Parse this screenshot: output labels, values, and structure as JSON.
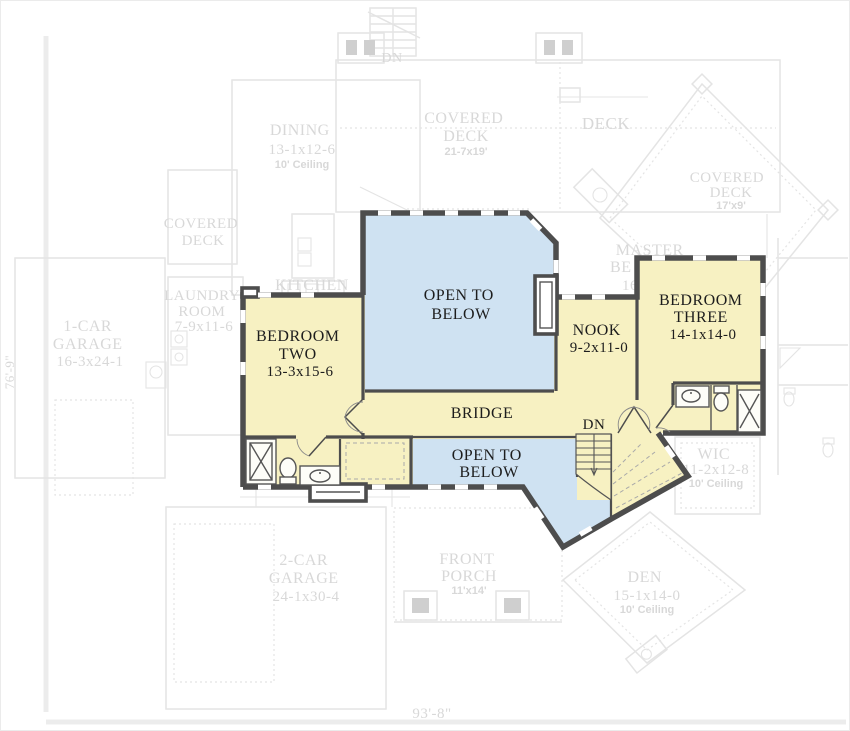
{
  "colors": {
    "room_fill": "#f7f1c2",
    "open_fill": "#cfe2f2",
    "wall": "#4d4d4d",
    "ghost": "#e4e4e4",
    "ghost_text": "#d8d8d8",
    "label_text": "#1d1d1d"
  },
  "dimensions": {
    "bottom_width": "93'-8\"",
    "left_height": "76'-9\""
  },
  "upper_floor": {
    "bedroom_two": {
      "l1": "BEDROOM",
      "l2": "TWO",
      "l3": "13-3x15-6"
    },
    "bedroom_three": {
      "l1": "BEDROOM",
      "l2": "THREE",
      "l3": "14-1x14-0"
    },
    "nook": {
      "l1": "NOOK",
      "l2": "9-2x11-0"
    },
    "open_to_below_main": {
      "l1": "OPEN TO",
      "l2": "BELOW"
    },
    "open_to_below_lower": {
      "l1": "OPEN TO",
      "l2": "BELOW"
    },
    "bridge": {
      "l1": "BRIDGE"
    },
    "stairs": {
      "l1": "DN"
    }
  },
  "ghost_floor": {
    "dn_top": {
      "l1": "DN"
    },
    "dining": {
      "l1": "DINING",
      "l2": "13-1x12-6",
      "l3": "10' Ceiling"
    },
    "covered_deck_top": {
      "l1": "COVERED",
      "l2": "DECK",
      "l3": "21-7x19'"
    },
    "deck": {
      "l1": "DECK"
    },
    "covered_deck_right": {
      "l1": "COVERED",
      "l2": "DECK",
      "l3": "17'x9'"
    },
    "master_bedroom": {
      "l1": "MASTER",
      "l2": "BE",
      "l3": "16"
    },
    "kitchen": {
      "l1": "KITCHEN"
    },
    "laundry": {
      "l1": "LAUNDRY",
      "l2": "ROOM",
      "l3": "7-9x11-6"
    },
    "covered_deck_left": {
      "l1": "COVERED",
      "l2": "DECK"
    },
    "garage_1": {
      "l1": "1-CAR",
      "l2": "GARAGE",
      "l3": "16-3x24-1"
    },
    "garage_2": {
      "l1": "2-CAR",
      "l2": "GARAGE",
      "l3": "24-1x30-4"
    },
    "front_porch": {
      "l1": "FRONT",
      "l2": "PORCH",
      "l3": "11'x14'"
    },
    "den": {
      "l1": "DEN",
      "l2": "15-1x14-0",
      "l3": "10' Ceiling"
    },
    "wic": {
      "l1": "WIC",
      "l2": "11-2x12-8",
      "l3": "10' Ceiling"
    }
  }
}
